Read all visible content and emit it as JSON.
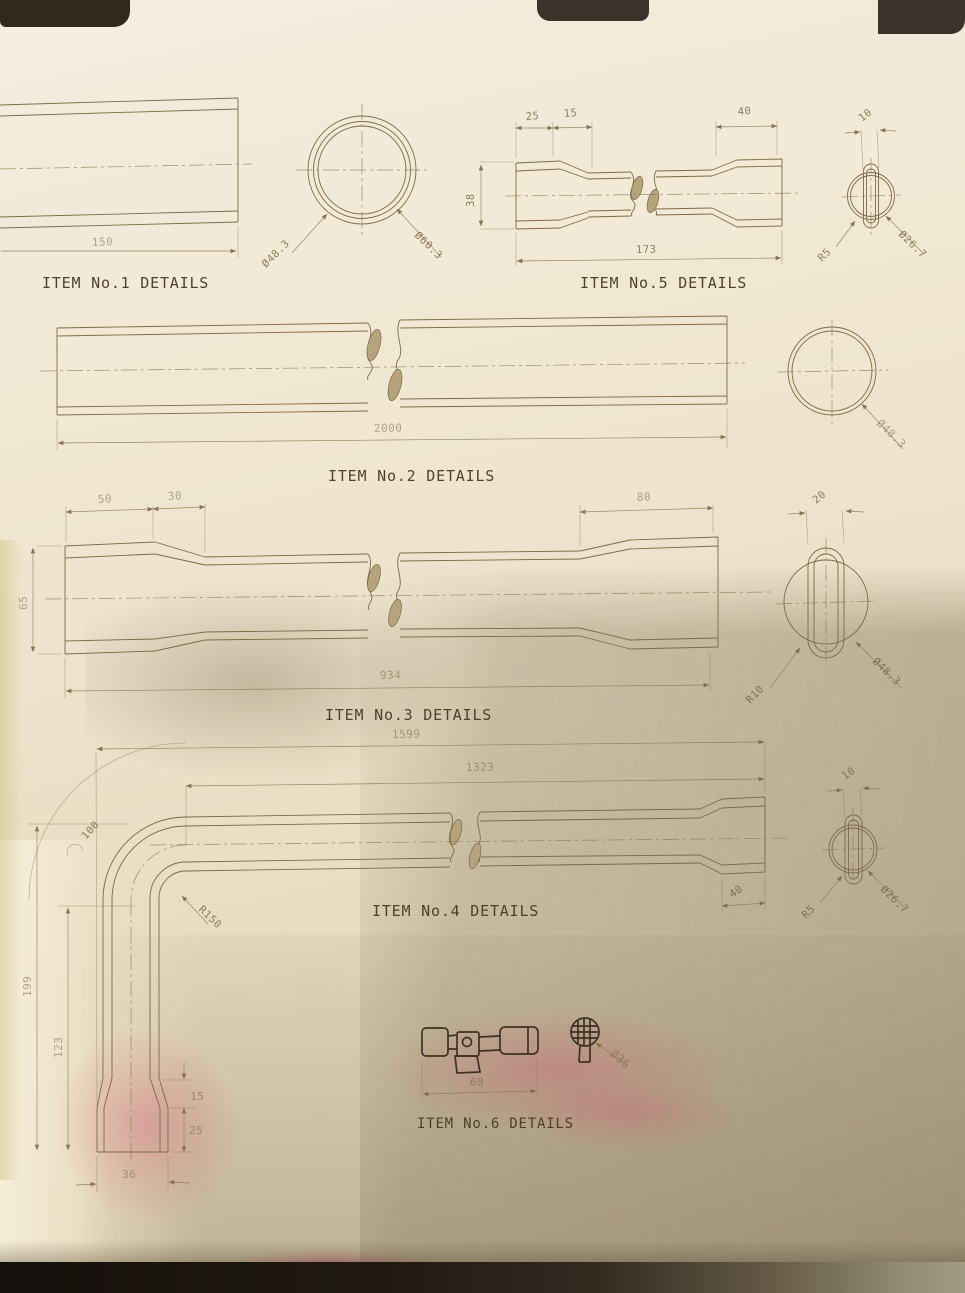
{
  "sheet": {
    "colors": {
      "paper": "#efe5d0",
      "ink": "#7b6a49",
      "shadow": "#77694e",
      "marker_pink": "#d04e6c",
      "caption": "#463a25"
    }
  },
  "captions": {
    "item1": "ITEM No.1 DETAILS",
    "item2": "ITEM No.2 DETAILS",
    "item3": "ITEM No.3 DETAILS",
    "item4": "ITEM No.4 DETAILS",
    "item5": "ITEM No.5 DETAILS",
    "item6": "ITEM No.6 DETAILS"
  },
  "dims": {
    "item1": {
      "length": "150",
      "dia_inner": "Ø48.3",
      "dia_outer": "Ø60.3"
    },
    "item2": {
      "length": "2000",
      "dia": "Ø48.3"
    },
    "item3": {
      "socket_len": "50",
      "taper_len": "30",
      "od": "65",
      "right_socket_len": "80",
      "length": "934",
      "slot_width": "20",
      "slot_radius": "R10",
      "dia": "Ø48.3"
    },
    "item4": {
      "overall_len": "1599",
      "straight_len": "1323",
      "bend_arc": "100",
      "bend_radius": "R150",
      "leg_height": "199",
      "leg_inner_height": "123",
      "taper_len": "15",
      "socket_len": "25",
      "end_width": "36",
      "right_socket_len": "40",
      "slot_width": "10",
      "slot_radius": "R5",
      "dia": "Ø26.7"
    },
    "item5": {
      "socket_len": "25",
      "taper_len": "15",
      "right_socket_len": "40",
      "od": "38",
      "length": "173",
      "slot_width": "10",
      "slot_radius": "R5",
      "dia": "Ø26.7"
    },
    "item6": {
      "length": "68",
      "dia": "Ø36"
    }
  }
}
